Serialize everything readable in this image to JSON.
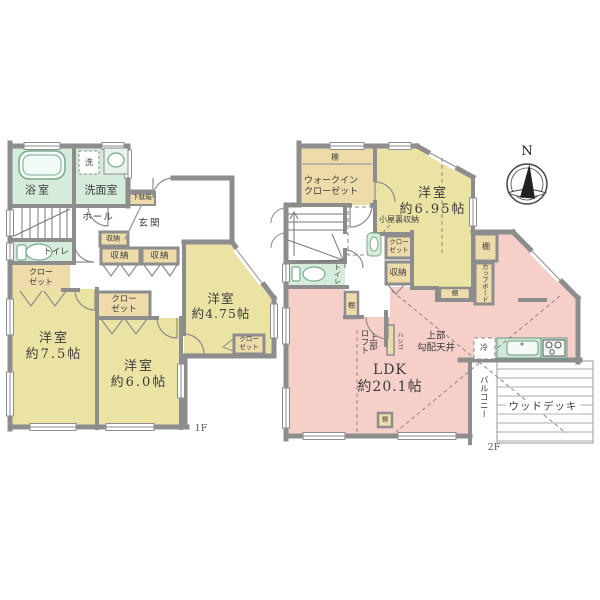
{
  "compass": {
    "north_label": "N"
  },
  "floor1": {
    "floor_label": "1F",
    "bath": "浴室",
    "washroom": "洗面室",
    "washer": "洗",
    "hall": "ホール",
    "shoe_cabinet": "下駄箱",
    "entrance": "玄関",
    "storage_small": "収納",
    "storage_left": "収納",
    "storage_right": "収納",
    "toilet": "トイレ",
    "closet_side": "クロー\nゼット",
    "room_75": "洋室\n約7.5帖",
    "closet_mid": "クロー\nゼット",
    "room_60": "洋室\n約6.0帖",
    "room_475": "洋室\n約4.75帖",
    "closet_corner": "クロー\nゼット"
  },
  "floor2": {
    "floor_label": "2F",
    "wic_shelf": "棚",
    "walk_in_closet": "ウォークイン\nクローゼット",
    "room_695": "洋室\n約6.95帖",
    "attic_storage": "小屋裏収納",
    "closet": "クロー\nゼット",
    "storage": "収納",
    "toilet": "トイレ",
    "shelf_hall": "棚",
    "shelf_dining": "棚",
    "cupboard": "カップボード",
    "shelf_dining2": "棚",
    "loft_above": "上部\nロフト",
    "ladder": "ハシゴ",
    "sloped_ceiling": "上部\n勾配天井",
    "ldk": "LDK\n約20.1帖",
    "refrigerator": "冷",
    "shelf_bottom": "棚",
    "balcony": "バルコニー",
    "wood_deck": "ウッドデッキ"
  },
  "colors": {
    "room_yellow": "#ebe3a4",
    "ldk_pink": "#f7cfc9",
    "wet_green": "#d5ecda",
    "closet_tan": "#eddbaa",
    "wall_gray": "#8d8d8d"
  }
}
